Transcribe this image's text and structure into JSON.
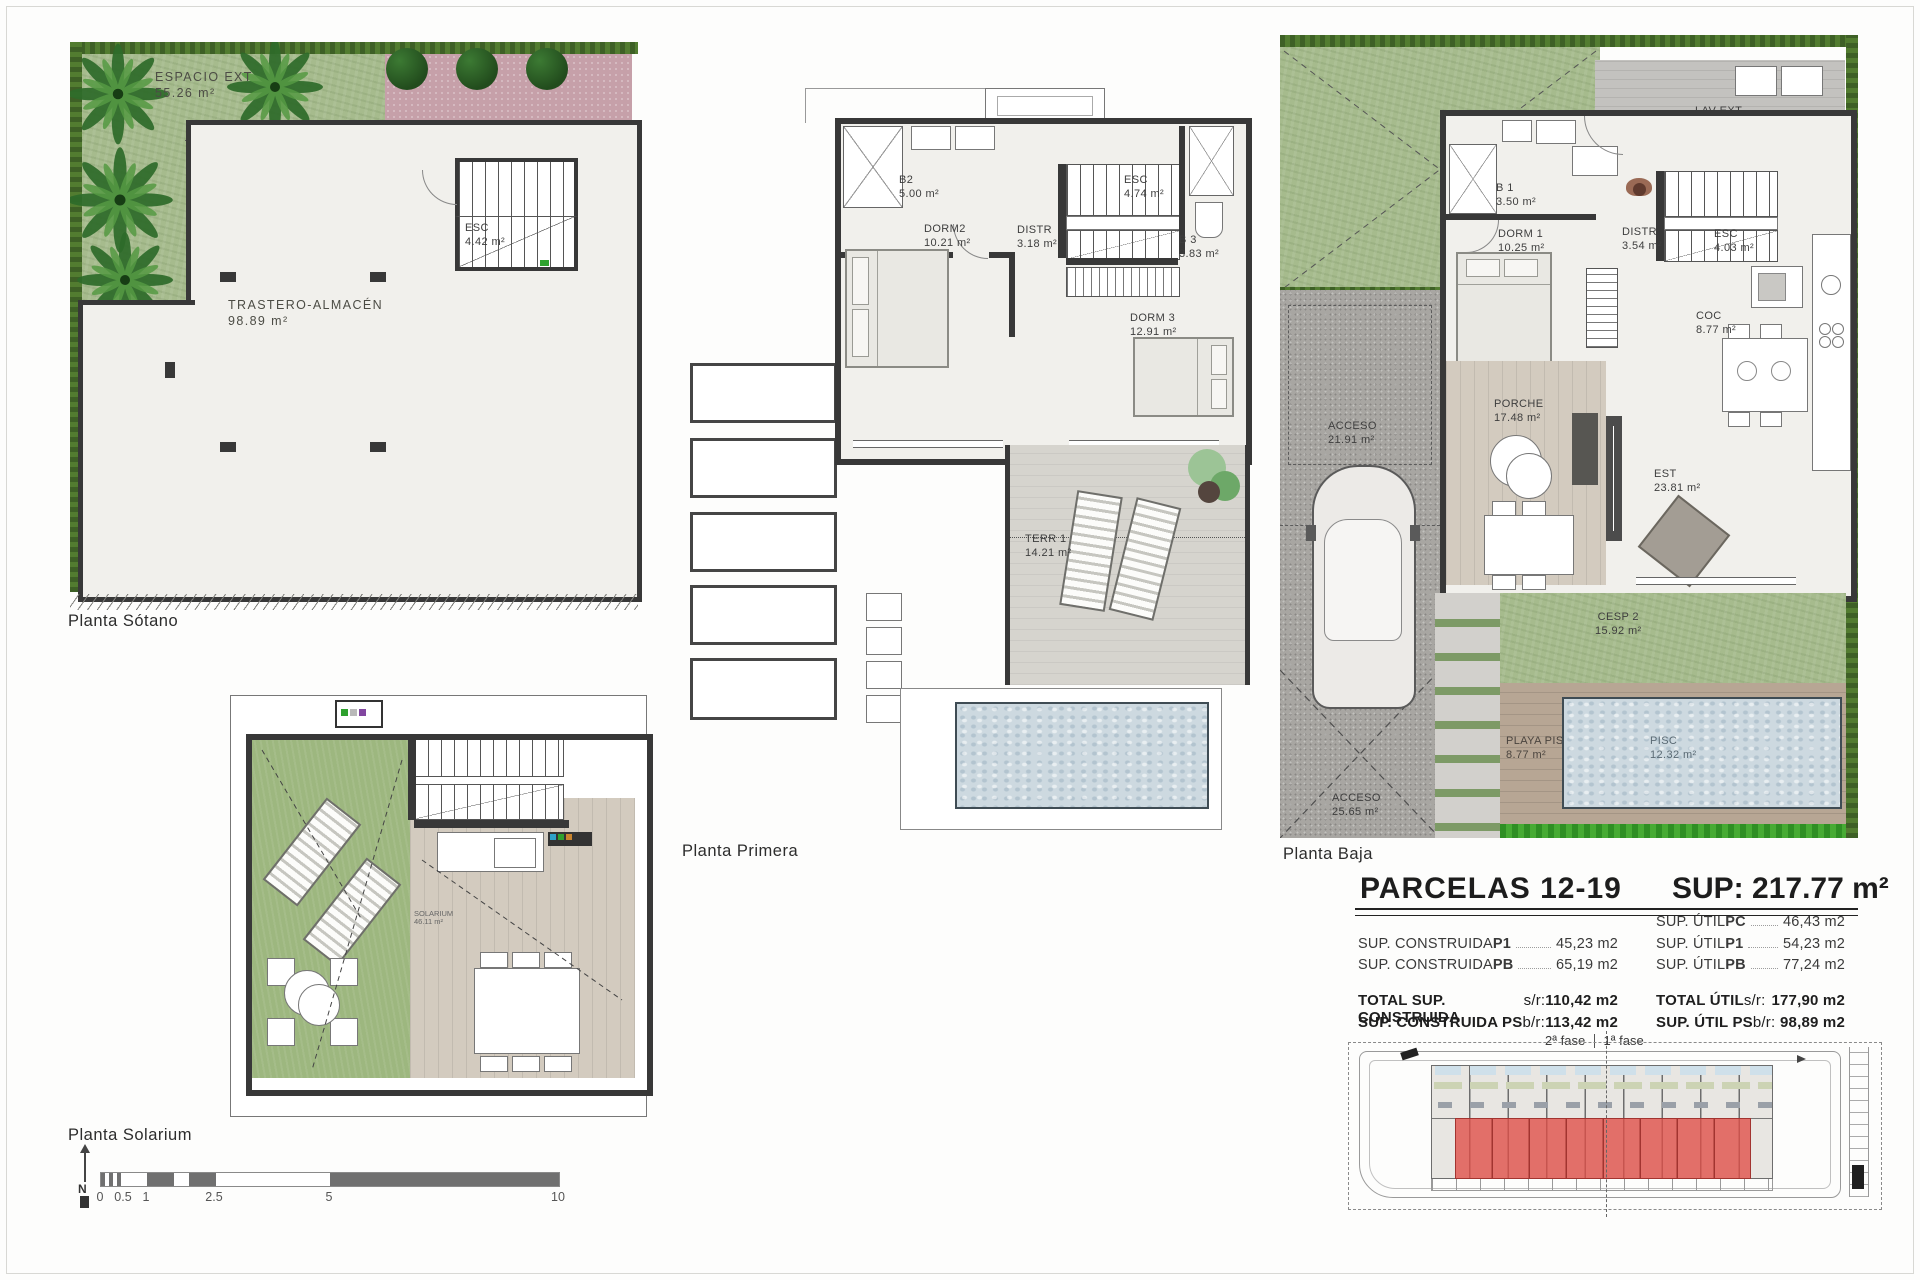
{
  "captions": {
    "sotano": "Planta Sótano",
    "solarium": "Planta Solarium",
    "primera": "Planta Primera",
    "baja": "Planta Baja"
  },
  "plans": {
    "sotano": {
      "rooms": {
        "espacio": {
          "label": "ESPACIO EXT",
          "area": "55.26 m²"
        },
        "esc": {
          "label": "ESC",
          "area": "4.42 m²"
        },
        "trastero": {
          "label": "TRASTERO-ALMACÉN",
          "area": "98.89 m²"
        }
      }
    },
    "primera": {
      "rooms": {
        "b2": {
          "label": "B2",
          "area": "5.00 m²"
        },
        "dorm2": {
          "label": "DORM2",
          "area": "10.21 m²"
        },
        "distr": {
          "label": "DISTR",
          "area": "3.18 m²"
        },
        "esc": {
          "label": "ESC",
          "area": "4.74 m²"
        },
        "b3": {
          "label": "B 3",
          "area": "3.83 m²"
        },
        "dorm3": {
          "label": "DORM 3",
          "area": "12.91 m²"
        },
        "terr1": {
          "label": "TERR 1",
          "area": "14.21 m²"
        }
      }
    },
    "baja": {
      "rooms": {
        "lavext": {
          "label": "LAV EXT",
          "area": "9.89 m²"
        },
        "b1": {
          "label": "B 1",
          "area": "3.50 m²"
        },
        "dorm1": {
          "label": "DORM 1",
          "area": "10.25 m²"
        },
        "distr": {
          "label": "DISTR",
          "area": "3.54 m²"
        },
        "esc": {
          "label": "ESC",
          "area": "4.03 m²"
        },
        "coc": {
          "label": "COC",
          "area": "8.77 m²"
        },
        "acceso": {
          "label": "ACCESO",
          "area": "21.91 m²"
        },
        "porche": {
          "label": "PORCHE",
          "area": "17.48 m²"
        },
        "est": {
          "label": "EST",
          "area": "23.81 m²"
        },
        "cesp2": {
          "label": "CESP 2",
          "area": "15.92 m²"
        },
        "playapisc": {
          "label": "PLAYA PISC",
          "area": "8.77 m²"
        },
        "pisc": {
          "label": "PISC",
          "area": "12.32 m²"
        },
        "acceso2": {
          "label": "ACCESO",
          "area": "25.65 m²"
        }
      }
    },
    "solarium": {
      "rooms": {
        "solarium": {
          "label": "SOLARIUM",
          "area": "46.11 m²"
        }
      }
    }
  },
  "summary": {
    "title": "PARCELAS 12-19",
    "sup": "SUP: 217.77 m²",
    "construida": [
      {
        "prefix": "SUP. CONSTRUIDA ",
        "key": "P1",
        "value": "45,23 m2"
      },
      {
        "prefix": "SUP. CONSTRUIDA ",
        "key": "PB",
        "value": "65,19 m2"
      }
    ],
    "util": [
      {
        "prefix": "SUP. ÚTIL ",
        "key": "PC",
        "value": "46,43 m2"
      },
      {
        "prefix": "SUP. ÚTIL ",
        "key": "P1",
        "value": "54,23 m2"
      },
      {
        "prefix": "SUP. ÚTIL ",
        "key": "PB",
        "value": "77,24 m2"
      }
    ],
    "totals_left": [
      {
        "label": "TOTAL SUP. CONSTRUIDA",
        "suffix": " s/r:",
        "value": "110,42 m2"
      },
      {
        "label": "SUP. CONSTRUIDA PS",
        "suffix": " b/r:",
        "value": "113,42 m2"
      }
    ],
    "totals_right": [
      {
        "label": "TOTAL ÚTIL",
        "suffix": " s/r:",
        "value": "177,90 m2"
      },
      {
        "label": "SUP. ÚTIL PS",
        "suffix": " b/r:",
        "value": "98,89 m2"
      }
    ],
    "phase_left": "2ª fase",
    "phase_right": "1ª fase"
  },
  "scalebar": {
    "north": "N",
    "ticks": [
      "0",
      "0.5",
      "1",
      "2.5",
      "5",
      "10"
    ]
  }
}
